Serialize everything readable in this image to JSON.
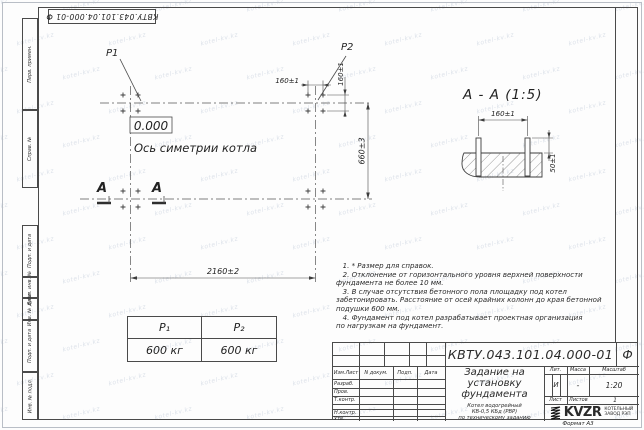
{
  "watermark": "kotel-kv.kz",
  "stamp_top": "КВТУ.043.101.04.000-01  Ф",
  "margin": {
    "perv": "Перв. примен.",
    "sprav": "Справ. №",
    "podp1": "Подп. и дата",
    "vzam": "Взам. инв. №",
    "dubl": "Инв. № дубл.",
    "podp2": "Подп. и дата",
    "podl": "Инв. № подл."
  },
  "plan": {
    "p1": "P1",
    "p2": "P2",
    "level": "0.000",
    "axis": "Ось симетрии котла",
    "dim_w": "2160±2",
    "dim_h": "660±3",
    "dim_spacing": "160±1",
    "section_letter": "А"
  },
  "section": {
    "title": "А - А (1:5)",
    "dim_span": "160±1",
    "dim_h": "50±1"
  },
  "load_table": {
    "headers": [
      "P₁",
      "P₂"
    ],
    "values": [
      "600 кг",
      "600 кг"
    ]
  },
  "notes": "   1. * Размер для справок.\n   2. Отклонение от горизонтального уровня верхней поверхности\nфундамента не более 10 мм.\n   3. В случае отсутствия бетонного пола площадку под котел\nзабетонировать. Расстояние от осей крайних колонн до края бетонной\nподушки 600 мм.\n   4. Фундамент под котел разрабатывает проектная организация\nпо нагрузкам на фундамент.",
  "title_block": {
    "doc_number": "КВТУ.043.101.04.000-01",
    "doc_suffix": "Ф",
    "title": "Задание на\nустановку\nфундамента",
    "subtitle": "Котел водогрейный\nКВ-0,5 КБд (РВР)\nпо техническому заданию",
    "col_izm": "Изм.Лист",
    "col_doc": "N докум.",
    "col_podp": "Подп.",
    "col_data": "Дата",
    "rows": [
      "Разраб.",
      "Пров.",
      "Т.контр.",
      "",
      "Н.контр.",
      "Утв."
    ],
    "lit_label": "Лит.",
    "massa_label": "Масса",
    "masshtab_label": "Масштаб",
    "lit_value": "И",
    "massa_value": "-",
    "masshtab_value": "1:20",
    "list_label": "Лист",
    "listov_label": "Листов",
    "listov_value": "1",
    "logo": "KVZR",
    "logo_sub": "КОТЕЛЬНЫЙ\nЗАВОД РЭП",
    "format": "Формат А3"
  }
}
